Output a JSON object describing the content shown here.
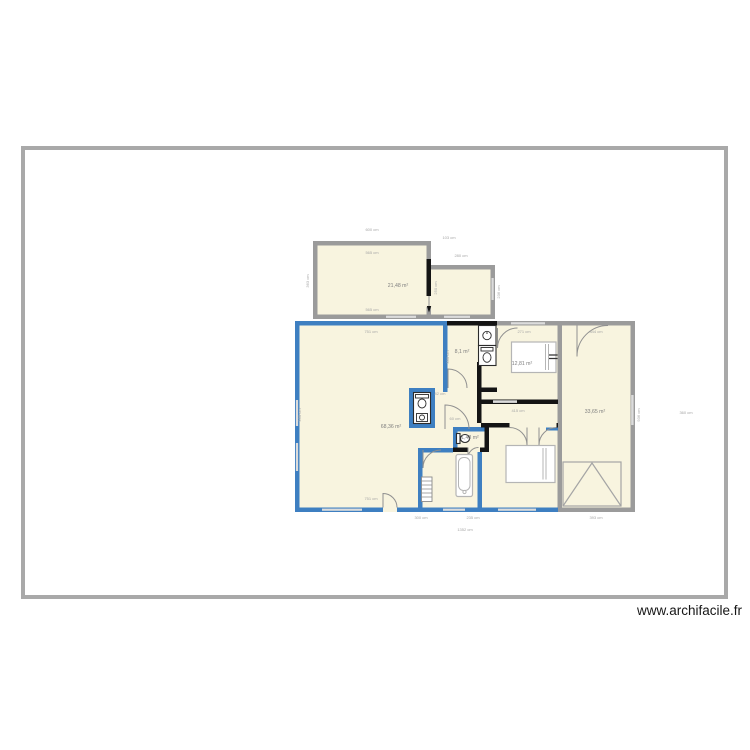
{
  "watermark": "www.archifacile.fr",
  "colors": {
    "boundary": "#a9a9a9",
    "wall_gray": "#9b9b9b",
    "wall_blue": "#3e7fc1",
    "wall_black": "#141414",
    "room_fill": "#f8f4df",
    "window": "#dcdcdc",
    "label_gray": "#7f7f7f"
  },
  "plan": {
    "room_labels": [
      {
        "room": "sejour",
        "text": "68,36 m²"
      },
      {
        "room": "chambre-nord",
        "text": "21,48 m²"
      },
      {
        "room": "cuisine",
        "text": "8,1 m²"
      },
      {
        "room": "chambre-est",
        "text": "12,81 m²"
      },
      {
        "room": "garage",
        "text": "33,65 m²"
      },
      {
        "room": "wc",
        "text": "1,43 m²"
      }
    ],
    "dim_labels": [
      "600 cm",
      "565 cm",
      "565 cm",
      "280 cm",
      "103 cm",
      "751 cm",
      "271 cm",
      "344 cm",
      "751 cm",
      "300 cm",
      "235 cm",
      "393 cm",
      "1352 cm",
      "415 cm",
      "82 cm",
      "60 cm",
      "363 cm",
      "930 cm",
      "250 cm",
      "236 cm",
      "330 cm",
      "936 cm",
      "360 cm"
    ]
  }
}
